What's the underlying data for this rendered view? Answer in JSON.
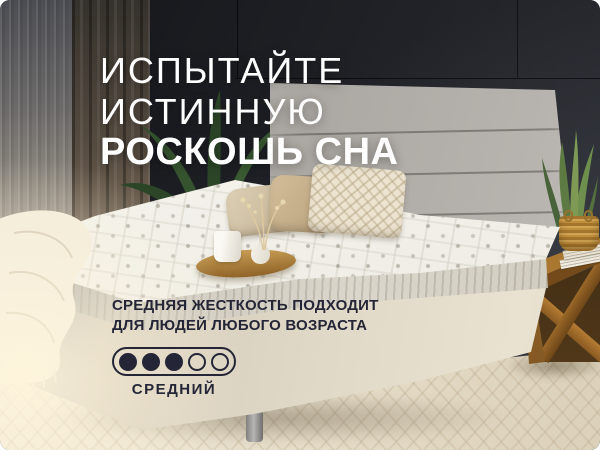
{
  "headline": {
    "line1": "ИСПЫТАЙТЕ",
    "line2": "ИСТИННУЮ",
    "line3": "РОСКОШЬ СНА",
    "color": "#ffffff"
  },
  "firmness": {
    "line1": "СРЕДНЯЯ ЖЕСТКОСТЬ ПОДХОДИТ",
    "line2": "ДЛЯ ЛЮДЕЙ ЛЮБОГО ВОЗРАСТА",
    "scale": {
      "total": 5,
      "filled": 3,
      "label": "СРЕДНИЙ"
    },
    "color": "#242637"
  },
  "colors": {
    "accent": "#242637",
    "headline": "#ffffff",
    "wall": "#202227",
    "headboard": "#b4b0ab",
    "bed_base": "#ddd5c4",
    "mattress": "#f3f1ea",
    "wood": "#a5722c",
    "floor": "#e9e1d0",
    "plant": "#35512f"
  }
}
